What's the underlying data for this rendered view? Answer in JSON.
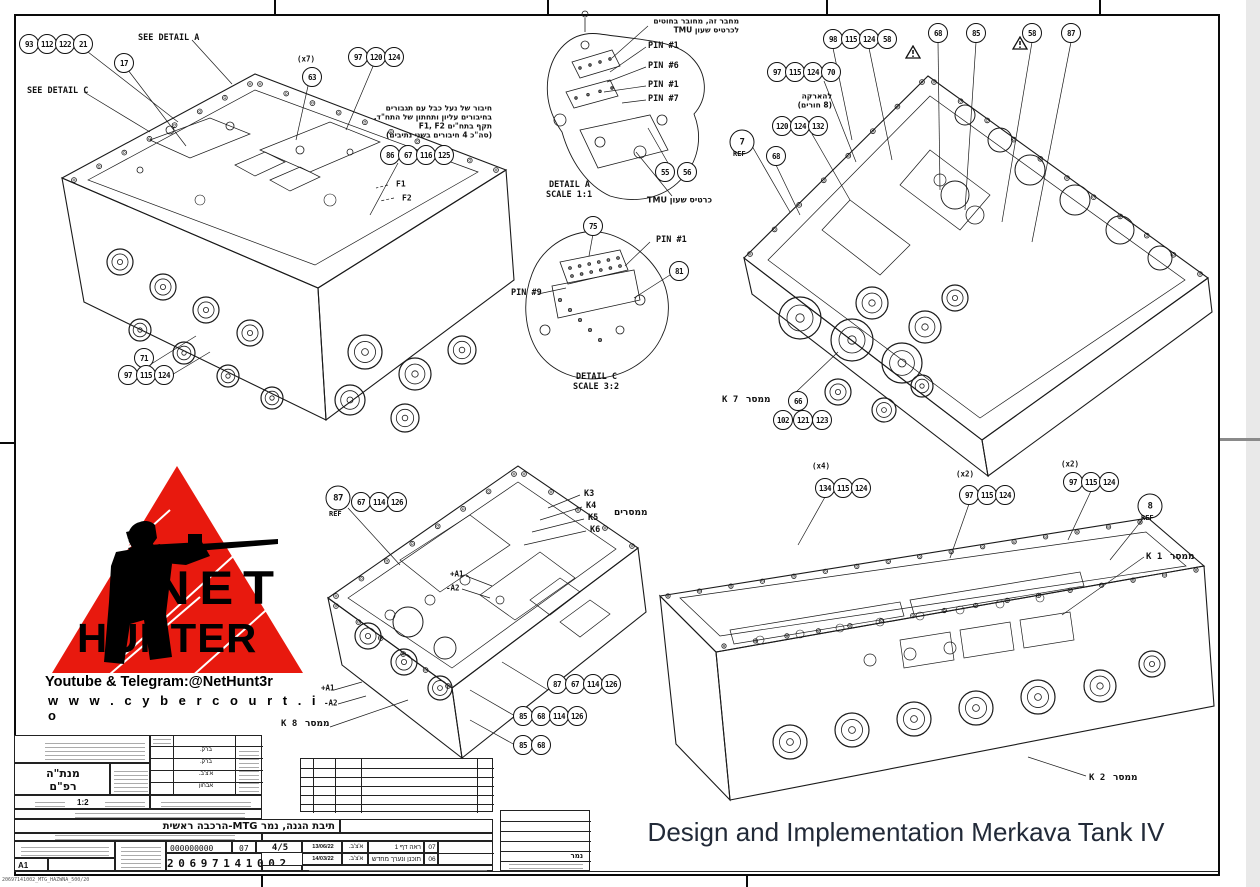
{
  "caption": "Design and Implementation Merkava Tank IV",
  "logo": {
    "word1": "NET",
    "word2": "HUNTER",
    "tagline": "Youtube & Telegram:@NetHunt3r",
    "url": "w w w . c y b e r c o u r t . i o",
    "triangle_color": "#e8190e"
  },
  "sheet": {
    "format": "A1",
    "footer_file": "20697141002_MTG_HAZWNA_500/20"
  },
  "title_block": {
    "unit_line1": "מנת\"ה",
    "unit_line2": "רפ\"ם",
    "scale": "1:2",
    "approvals": [
      "ברק.",
      "ברק.",
      "א'צ'ב.",
      "אבחון"
    ],
    "assembly_title": "תיבת הגנה, נמר MTG-הרכבה ראשית",
    "zeros": "000000000",
    "rev": "07",
    "sheet_no": "4/5",
    "drawing_number": "2 0 6 9 7 1 4 1 0 0 2",
    "project": "נמר",
    "revisions": [
      {
        "rev": "07",
        "desc": "ראה דף 1",
        "sig": "א'צ'ב.",
        "date": "13/06/22"
      },
      {
        "rev": "06",
        "desc": "תוכנן ונערך מחדש",
        "sig": "א'צ'ב.",
        "date": "14/03/22"
      }
    ]
  },
  "annotations": [
    {
      "x": 29,
      "y": 44,
      "t": "93",
      "k": "b"
    },
    {
      "x": 47,
      "y": 44,
      "t": "112",
      "k": "b"
    },
    {
      "x": 65,
      "y": 44,
      "t": "122",
      "k": "b"
    },
    {
      "x": 83,
      "y": 44,
      "t": "21",
      "k": "b"
    },
    {
      "x": 124,
      "y": 63,
      "t": "17",
      "k": "b"
    },
    {
      "x": 138,
      "y": 38,
      "t": "SEE DETAIL A",
      "k": "l"
    },
    {
      "x": 27,
      "y": 91,
      "t": "SEE DETAIL C",
      "k": "l"
    },
    {
      "x": 297,
      "y": 59,
      "t": "(x7)",
      "k": "l",
      "s": 7.5
    },
    {
      "x": 312,
      "y": 77,
      "t": "63",
      "k": "b"
    },
    {
      "x": 358,
      "y": 57,
      "t": "97",
      "k": "b"
    },
    {
      "x": 376,
      "y": 57,
      "t": "120",
      "k": "b"
    },
    {
      "x": 394,
      "y": 57,
      "t": "124",
      "k": "b"
    },
    {
      "x": 492,
      "y": 108,
      "t": "חיבור של נעל כבל עם תגבורים",
      "k": "h",
      "a": "r",
      "s": 7.5
    },
    {
      "x": 492,
      "y": 117,
      "t": "בחיבורים עליון ותחתון של התח\"ד.",
      "k": "h",
      "a": "r",
      "s": 7.5
    },
    {
      "x": 492,
      "y": 126,
      "t": "תקף בתח\"ים F1, F2",
      "k": "h",
      "a": "r",
      "s": 7.5
    },
    {
      "x": 492,
      "y": 135,
      "t": "(סה\"כ 4 חיבורים בשני נתיבים)",
      "k": "h",
      "a": "r",
      "s": 7.5
    },
    {
      "x": 390,
      "y": 155,
      "t": "86",
      "k": "b"
    },
    {
      "x": 408,
      "y": 155,
      "t": "67",
      "k": "b"
    },
    {
      "x": 426,
      "y": 155,
      "t": "116",
      "k": "b"
    },
    {
      "x": 444,
      "y": 155,
      "t": "125",
      "k": "b"
    },
    {
      "x": 396,
      "y": 184,
      "t": "F1",
      "k": "l",
      "s": 8
    },
    {
      "x": 402,
      "y": 198,
      "t": "F2",
      "k": "l",
      "s": 8
    },
    {
      "x": 144,
      "y": 358,
      "t": "71",
      "k": "b"
    },
    {
      "x": 128,
      "y": 375,
      "t": "97",
      "k": "b"
    },
    {
      "x": 146,
      "y": 375,
      "t": "115",
      "k": "b"
    },
    {
      "x": 164,
      "y": 375,
      "t": "124",
      "k": "b"
    },
    {
      "x": 739,
      "y": 21,
      "t": "מחבר זה, מחובר בחוטים",
      "k": "h",
      "a": "r",
      "s": 7.5
    },
    {
      "x": 739,
      "y": 30,
      "t": "לכרטיס שעון TMU",
      "k": "h",
      "a": "r",
      "s": 7.5
    },
    {
      "x": 648,
      "y": 46,
      "t": "PIN #1",
      "k": "l"
    },
    {
      "x": 648,
      "y": 66,
      "t": "PIN #6",
      "k": "l"
    },
    {
      "x": 648,
      "y": 85,
      "t": "PIN #1",
      "k": "l"
    },
    {
      "x": 648,
      "y": 99,
      "t": "PIN #7",
      "k": "l"
    },
    {
      "x": 665,
      "y": 172,
      "t": "55",
      "k": "b"
    },
    {
      "x": 687,
      "y": 172,
      "t": "56",
      "k": "b"
    },
    {
      "x": 549,
      "y": 185,
      "t": "DETAIL A",
      "k": "l"
    },
    {
      "x": 546,
      "y": 195,
      "t": "SCALE 1:1",
      "k": "l"
    },
    {
      "x": 712,
      "y": 200,
      "t": "כרטיס שעון TMU",
      "k": "h",
      "a": "r",
      "s": 8
    },
    {
      "x": 593,
      "y": 226,
      "t": "75",
      "k": "b"
    },
    {
      "x": 656,
      "y": 240,
      "t": "PIN #1",
      "k": "l"
    },
    {
      "x": 679,
      "y": 271,
      "t": "81",
      "k": "b"
    },
    {
      "x": 511,
      "y": 293,
      "t": "PIN #9",
      "k": "l"
    },
    {
      "x": 576,
      "y": 377,
      "t": "DETAIL C",
      "k": "l"
    },
    {
      "x": 573,
      "y": 387,
      "t": "SCALE 3:2",
      "k": "l"
    },
    {
      "x": 833,
      "y": 39,
      "t": "98",
      "k": "b"
    },
    {
      "x": 851,
      "y": 39,
      "t": "115",
      "k": "b"
    },
    {
      "x": 869,
      "y": 39,
      "t": "124",
      "k": "b"
    },
    {
      "x": 887,
      "y": 39,
      "t": "58",
      "k": "b"
    },
    {
      "x": 905,
      "y": 45,
      "t": "",
      "k": "w"
    },
    {
      "x": 938,
      "y": 33,
      "t": "68",
      "k": "b"
    },
    {
      "x": 976,
      "y": 33,
      "t": "85",
      "k": "b"
    },
    {
      "x": 1012,
      "y": 36,
      "t": "",
      "k": "w"
    },
    {
      "x": 1032,
      "y": 33,
      "t": "58",
      "k": "b"
    },
    {
      "x": 1071,
      "y": 33,
      "t": "87",
      "k": "b"
    },
    {
      "x": 777,
      "y": 72,
      "t": "97",
      "k": "b"
    },
    {
      "x": 795,
      "y": 72,
      "t": "115",
      "k": "b"
    },
    {
      "x": 813,
      "y": 72,
      "t": "124",
      "k": "b"
    },
    {
      "x": 831,
      "y": 72,
      "t": "70",
      "k": "b"
    },
    {
      "x": 832,
      "y": 96,
      "t": "להארקה",
      "k": "h",
      "a": "r",
      "s": 7.5
    },
    {
      "x": 832,
      "y": 105,
      "t": "(8 חורים)",
      "k": "h",
      "a": "r",
      "s": 7.5
    },
    {
      "x": 782,
      "y": 126,
      "t": "120",
      "k": "b"
    },
    {
      "x": 800,
      "y": 126,
      "t": "124",
      "k": "b"
    },
    {
      "x": 818,
      "y": 126,
      "t": "132",
      "k": "b"
    },
    {
      "x": 742,
      "y": 142,
      "t": "7",
      "k": "B"
    },
    {
      "x": 733,
      "y": 154,
      "t": "REF",
      "k": "l",
      "s": 7
    },
    {
      "x": 776,
      "y": 156,
      "t": "68",
      "k": "b"
    },
    {
      "x": 722,
      "y": 400,
      "t": "K 7",
      "k": "l",
      "s": 9
    },
    {
      "x": 746,
      "y": 400,
      "t": "ממסר",
      "k": "h",
      "s": 9
    },
    {
      "x": 798,
      "y": 401,
      "t": "66",
      "k": "b"
    },
    {
      "x": 783,
      "y": 420,
      "t": "102",
      "k": "b"
    },
    {
      "x": 803,
      "y": 420,
      "t": "121",
      "k": "b"
    },
    {
      "x": 822,
      "y": 420,
      "t": "123",
      "k": "b"
    },
    {
      "x": 338,
      "y": 498,
      "t": "87",
      "k": "B"
    },
    {
      "x": 361,
      "y": 502,
      "t": "67",
      "k": "b"
    },
    {
      "x": 379,
      "y": 502,
      "t": "114",
      "k": "b"
    },
    {
      "x": 397,
      "y": 502,
      "t": "126",
      "k": "b"
    },
    {
      "x": 329,
      "y": 514,
      "t": "REF",
      "k": "l",
      "s": 7
    },
    {
      "x": 584,
      "y": 494,
      "t": "K3",
      "k": "l"
    },
    {
      "x": 586,
      "y": 506,
      "t": "K4",
      "k": "l"
    },
    {
      "x": 588,
      "y": 518,
      "t": "K5",
      "k": "l"
    },
    {
      "x": 590,
      "y": 530,
      "t": "K6",
      "k": "l"
    },
    {
      "x": 614,
      "y": 513,
      "t": "ממסרים",
      "k": "h",
      "s": 9
    },
    {
      "x": 450,
      "y": 574,
      "t": "+A1",
      "k": "l",
      "s": 7.5
    },
    {
      "x": 446,
      "y": 588,
      "t": "-A2",
      "k": "l",
      "s": 7.5
    },
    {
      "x": 321,
      "y": 688,
      "t": "+A1",
      "k": "l",
      "s": 7.5
    },
    {
      "x": 324,
      "y": 703,
      "t": "-A2",
      "k": "l",
      "s": 7.5
    },
    {
      "x": 281,
      "y": 724,
      "t": "K 8",
      "k": "l",
      "s": 9
    },
    {
      "x": 305,
      "y": 724,
      "t": "ממסר",
      "k": "h",
      "s": 9
    },
    {
      "x": 557,
      "y": 684,
      "t": "87",
      "k": "b"
    },
    {
      "x": 575,
      "y": 684,
      "t": "67",
      "k": "b"
    },
    {
      "x": 593,
      "y": 684,
      "t": "114",
      "k": "b"
    },
    {
      "x": 611,
      "y": 684,
      "t": "126",
      "k": "b"
    },
    {
      "x": 523,
      "y": 716,
      "t": "85",
      "k": "b"
    },
    {
      "x": 541,
      "y": 716,
      "t": "68",
      "k": "b"
    },
    {
      "x": 559,
      "y": 716,
      "t": "114",
      "k": "b"
    },
    {
      "x": 577,
      "y": 716,
      "t": "126",
      "k": "b"
    },
    {
      "x": 523,
      "y": 745,
      "t": "85",
      "k": "b"
    },
    {
      "x": 541,
      "y": 745,
      "t": "68",
      "k": "b"
    },
    {
      "x": 812,
      "y": 466,
      "t": "(x4)",
      "k": "l",
      "s": 7.5
    },
    {
      "x": 825,
      "y": 488,
      "t": "134",
      "k": "b"
    },
    {
      "x": 843,
      "y": 488,
      "t": "115",
      "k": "b"
    },
    {
      "x": 861,
      "y": 488,
      "t": "124",
      "k": "b"
    },
    {
      "x": 956,
      "y": 474,
      "t": "(x2)",
      "k": "l",
      "s": 7.5
    },
    {
      "x": 969,
      "y": 495,
      "t": "97",
      "k": "b"
    },
    {
      "x": 987,
      "y": 495,
      "t": "115",
      "k": "b"
    },
    {
      "x": 1005,
      "y": 495,
      "t": "124",
      "k": "b"
    },
    {
      "x": 1061,
      "y": 464,
      "t": "(x2)",
      "k": "l",
      "s": 7.5
    },
    {
      "x": 1073,
      "y": 482,
      "t": "97",
      "k": "b"
    },
    {
      "x": 1091,
      "y": 482,
      "t": "115",
      "k": "b"
    },
    {
      "x": 1109,
      "y": 482,
      "t": "124",
      "k": "b"
    },
    {
      "x": 1150,
      "y": 506,
      "t": "8",
      "k": "B"
    },
    {
      "x": 1141,
      "y": 518,
      "t": "REF",
      "k": "l",
      "s": 7
    },
    {
      "x": 1146,
      "y": 557,
      "t": "K 1",
      "k": "l",
      "s": 9
    },
    {
      "x": 1170,
      "y": 557,
      "t": "ממסר",
      "k": "h",
      "s": 9
    },
    {
      "x": 1089,
      "y": 778,
      "t": "K 2",
      "k": "l",
      "s": 9
    },
    {
      "x": 1113,
      "y": 778,
      "t": "ממסר",
      "k": "h",
      "s": 9
    }
  ]
}
